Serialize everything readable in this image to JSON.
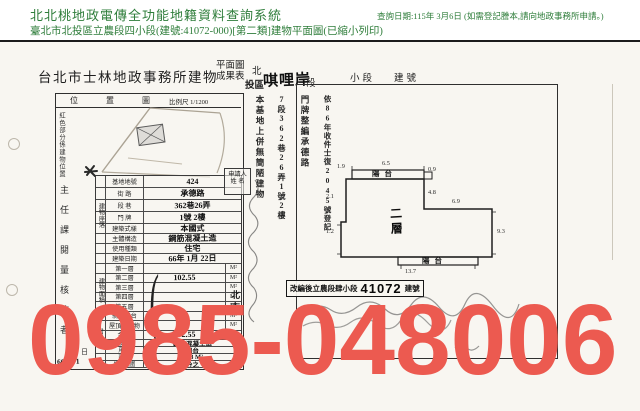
{
  "header": {
    "system_title": "北北桃地政電傳全功能地籍資料查詢系統",
    "query_note": "查詢日期:115年 3月6日 (如需登記謄本,請向地政事務所申請。)",
    "subtitle": "臺北市北投區立農段四小段(建號:41072-000)[第二類]建物平面圖(已縮小列印)",
    "accent_color": "#2e7d3a"
  },
  "document": {
    "office_title": "台北市士林地政事務所建物",
    "title_stack_top": "平面圖",
    "title_stack_bottom": "成果表",
    "district_char": "北",
    "district_rest": "投區",
    "section_handwritten": "唭哩岸",
    "section_label": "段",
    "subsection_label": "小段",
    "building_no_label": "建號"
  },
  "location_box": {
    "title": "位 置 圖",
    "scale": "比例尺 1/1200",
    "red_note": "紅色部分係建物位置",
    "sign_column": "主任課閱量核校者",
    "day_label": "日",
    "date_value": "66. 2. 1"
  },
  "margin_notes": {
    "note_a": "依86年收件士復2045號登記",
    "note_b": "門牌整編承德路",
    "note_c": "7段362巷26弄1號2樓",
    "note_d": "本基地上併無簡陋建物"
  },
  "applicant": {
    "line1": "申請人",
    "line2": "姓 名",
    "city_stamp": "北市"
  },
  "building_table": {
    "spine_a": "建物座落",
    "spine_c": "建物面積",
    "spine_d": "附屬建物",
    "rows_a": [
      {
        "label": "基地地號",
        "value": "424"
      },
      {
        "label": "街  路",
        "value": "承德路"
      },
      {
        "label": "段  巷",
        "value": "362巷26弄"
      },
      {
        "label": "門  牌",
        "value": "1號 2樓"
      }
    ],
    "rows_b": [
      {
        "label": "建築式樣",
        "value": "本國式"
      },
      {
        "label": "主體構造",
        "value": "鋼筋混凝土造"
      },
      {
        "label": "使用種類",
        "value": "住宅"
      },
      {
        "label": "建築日期",
        "value": "66年 1月 22日"
      }
    ],
    "rows_c": [
      {
        "label": "第一層",
        "value": "",
        "unit": "M²"
      },
      {
        "label": "第二層",
        "value": "102.55",
        "unit": "M²"
      },
      {
        "label": "第三層",
        "value": "",
        "unit": "M²"
      },
      {
        "label": "第四層",
        "value": "",
        "unit": "M²"
      },
      {
        "label": "第五層",
        "value": "",
        "unit": "M²"
      },
      {
        "label": "騎樓平台",
        "value": "",
        "unit": "M²"
      },
      {
        "label": "屋頂突出物",
        "value": "",
        "unit": "M²"
      },
      {
        "label": "合  計",
        "value": "102.55",
        "unit": "M²"
      }
    ],
    "rows_d": [
      {
        "label": "主要構造",
        "value": "鋼筋混凝土造"
      },
      {
        "label": "用  途",
        "value": "陽台"
      },
      {
        "label": "面  積",
        "value": "7.18 M²"
      },
      {
        "label": "權利範圍",
        "value": "分之"
      }
    ]
  },
  "plan": {
    "balcony_top": "陽台",
    "balcony_bottom": "陽台",
    "floor_label": "二層",
    "dims": {
      "top": "6.5",
      "top_left": "1.9",
      "corner": "0.9",
      "right_upper": "4.8",
      "mid": "6.9",
      "right_lower": "9.3",
      "bottom": "13.7",
      "left_upper": "2.1",
      "left_lower": "1.2"
    },
    "stamp": {
      "prefix": "改編後立農段肆小段",
      "number": "41072",
      "suffix": "建號"
    }
  },
  "watermark": {
    "text": "0985-048006",
    "color": "#ec5a50"
  }
}
